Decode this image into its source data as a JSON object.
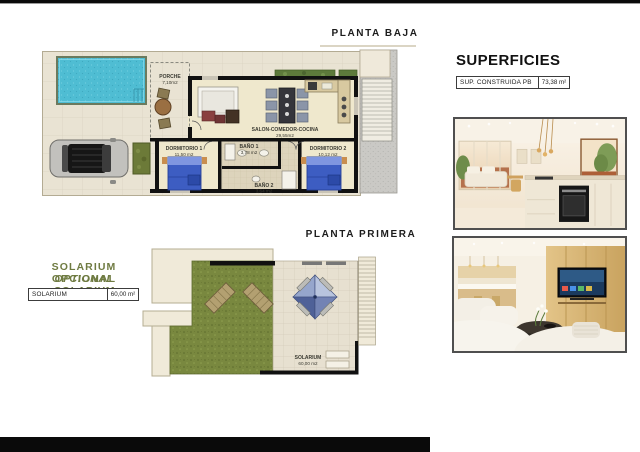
{
  "ground_floor": {
    "title": "PLANTA BAJA",
    "rooms": {
      "porche": {
        "name": "PORCHE",
        "area": "7,10m2"
      },
      "salon": {
        "name": "SALON-COMEDOR-COCINA",
        "area": "29,55m2"
      },
      "dorm1": {
        "name": "DORMITORIO 1",
        "area": "11,50 m2"
      },
      "bano1": {
        "name": "BAÑO 1",
        "area": "3,78 m2"
      },
      "bano2": {
        "name": "BAÑO 2",
        "area": "3,64 m2"
      },
      "dorm2": {
        "name": "DORMITORIO 2",
        "area": "10,12 m2"
      }
    }
  },
  "first_floor": {
    "title": "PLANTA PRIMERA",
    "solarium": {
      "name": "SOLARIUM",
      "area": "60,00 m2"
    }
  },
  "superficies": {
    "title": "SUPERFICIES",
    "row_label": "SUP. CONSTRUIDA PB",
    "row_value": "73,38 m²"
  },
  "solarium_note": {
    "line_es": "SOLARIUM OPCIONAL",
    "line_en": "OPTIONAL SOLARIUM",
    "row_label": "SOLARIUM",
    "row_value": "60,00 m²"
  },
  "colors": {
    "accent_green_text": "#6f7b42",
    "pool_blue": "#4fbdd3",
    "grass_green": "#79883f",
    "bed_blue": "#3d5dc2",
    "wall_black": "#111111",
    "floor_cream": "#efe8d2",
    "gravel_gray": "#cac9c5"
  }
}
